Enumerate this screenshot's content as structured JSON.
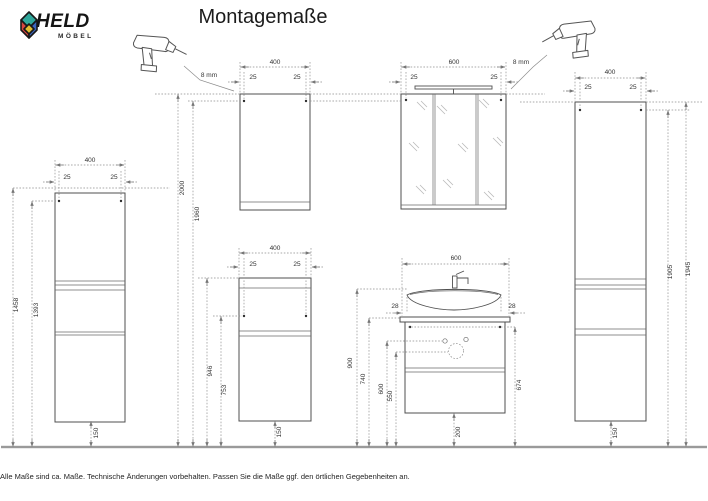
{
  "header": {
    "brand": "HELD",
    "brand_sub": "MÖBEL",
    "title": "Montagemaße"
  },
  "drills": {
    "left_label": "8 mm",
    "right_label": "8 mm"
  },
  "cabinets": {
    "left_tall": {
      "width": "400",
      "inset_left": "25",
      "inset_right": "25",
      "height_top": "1458",
      "height_holes": "1393",
      "floor_gap": "150"
    },
    "wall_cabinet": {
      "width": "400",
      "inset_left": "25",
      "inset_right": "25",
      "height_top": "2000",
      "height_holes": "1960"
    },
    "mid_cabinet": {
      "width": "400",
      "inset_left": "25",
      "inset_right": "25",
      "height_top": "946",
      "height_holes": "753",
      "floor_gap": "150"
    },
    "mirror_cabinet": {
      "width": "600",
      "inset_left": "25",
      "inset_right": "25"
    },
    "vanity": {
      "width": "600",
      "gap_left": "28",
      "gap_right": "28",
      "height_basin": "900",
      "height_top": "740",
      "height_hole_upper": "600",
      "height_hole_lower": "550",
      "height_holes_right": "674",
      "floor_gap": "200"
    },
    "right_tall": {
      "width": "400",
      "inset_left": "25",
      "inset_right": "25",
      "height_holes": "1905",
      "height_top": "1945",
      "floor_gap": "150"
    }
  },
  "footer": {
    "note": "Alle Maße sind ca. Maße. Technische Änderungen vorbehalten. Passen Sie die Maße ggf. den örtlichen Gegebenheiten an."
  },
  "colors": {
    "logo_teal": "#2fa79b",
    "logo_red": "#d8453e",
    "logo_yellow": "#e3bc2f",
    "logo_blue": "#3b66bd",
    "line": "#4f4f4f",
    "dim_line": "#8f8f8f",
    "floor": "#9a9a9a"
  }
}
